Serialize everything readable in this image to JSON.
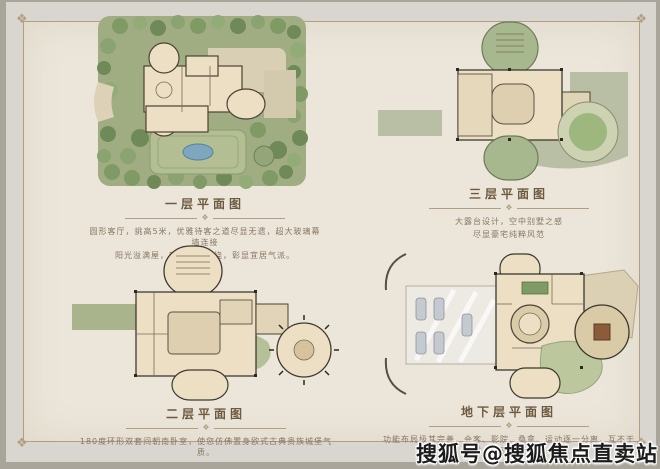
{
  "palette": {
    "outer_edge": "#a9a59b",
    "card_gray": "#d9d6cf",
    "cream": "#ece6da",
    "frame": "#b29f82",
    "title_color": "#6e5a40",
    "desc_color": "#877663",
    "watermark_color": "#1c1c1c",
    "garden_green": "#a0ad82",
    "plan_beige": "#ecdfc3",
    "terrace_sage": "#b9bfa4",
    "pool_blue": "#7fa6bf"
  },
  "ornaments": {
    "divider_glyph": "❖",
    "corner_glyph": "❖"
  },
  "sections": {
    "floor1": {
      "title": "一层平面图",
      "desc1": "圆形客厅，挑高5米，优雅待客之道尽显无遗，超大玻璃幕墙连接",
      "desc2": "阳光溢满屋，四周花园围绕，彰显宜居气派。"
    },
    "floor3": {
      "title": "三层平面图",
      "desc1": "大露台设计，空中别墅之感",
      "desc2": "尽显豪宅纯粹风范"
    },
    "floor2": {
      "title": "二层平面图",
      "desc1": "180度环形双套间朝南卧室，使您仿佛置身欧式古典贵族城堡气质。"
    },
    "basement": {
      "title": "地下层平面图",
      "desc1": "功能布局极其完善，会客、影院、桑拿、运动逐一分离，互不干扰，私密性极佳。"
    }
  },
  "watermark": {
    "text": "搜狐号@搜狐焦点直卖站"
  }
}
